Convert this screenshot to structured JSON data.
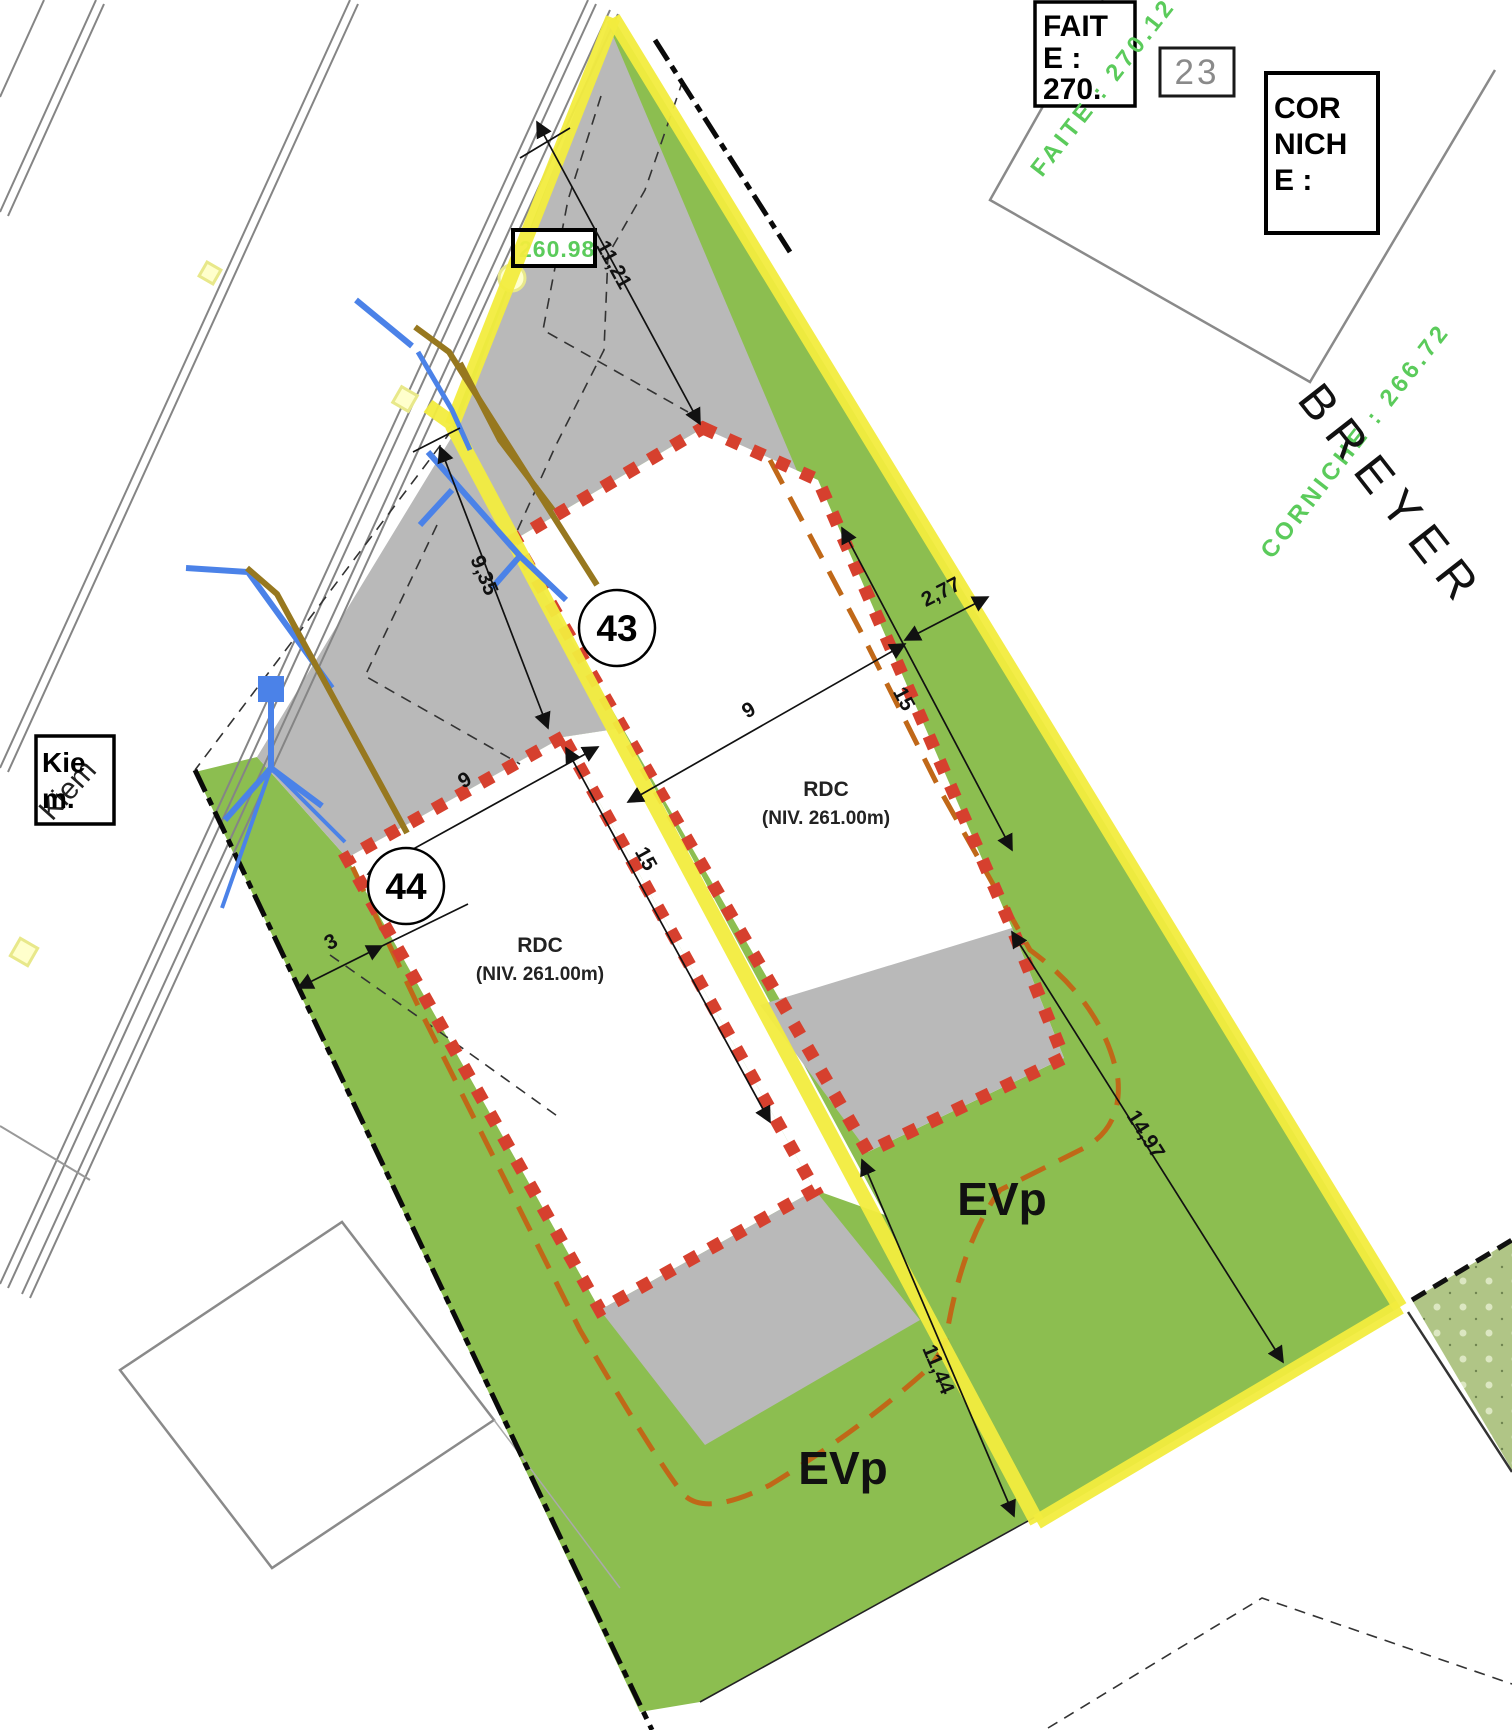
{
  "plan": {
    "parcels": {
      "p43": "43",
      "p44": "44"
    },
    "buildings": {
      "b43": {
        "line1": "RDC",
        "line2": "(NIV.  261.00m)"
      },
      "b44": {
        "line1": "RDC",
        "line2": "(NIV.  261.00m)"
      }
    },
    "green_areas": {
      "evp_right": "EVp",
      "evp_left": "EVp"
    },
    "dims": {
      "d1121": "11,21",
      "d935": "9,35",
      "d277": "2,77",
      "d15a": "15",
      "d9a": "9",
      "d9b": "9",
      "d15b": "15",
      "d3": "3",
      "d1497": "14,97",
      "d1144": "11,44"
    },
    "annotations": {
      "faite_box_lines": [
        "FAIT",
        "E :",
        "270."
      ],
      "faite_green": "FAITE : 270.12",
      "corniche_box_lines": [
        "COR",
        "NICH",
        "E :"
      ],
      "corniche_green": "CORNICHE : 266.72",
      "parcel_23": "23",
      "kiem_box_lines": [
        "Kie",
        "m."
      ],
      "kiem_thin": "Kiem",
      "street_breyer": "BREYER",
      "level_marker": "260.98"
    },
    "colors": {
      "green": "#8cbe50",
      "green_texture": "#b7cd92",
      "gray": "#b9b9b9",
      "yellow": "#f2ec3e",
      "red_dotted": "#d6402e",
      "orange_dash": "#c06818",
      "blue_utility": "#4b82e8",
      "brown_utility": "#97781f",
      "green_text": "#5bcb5b",
      "road_gray": "#888888"
    }
  }
}
